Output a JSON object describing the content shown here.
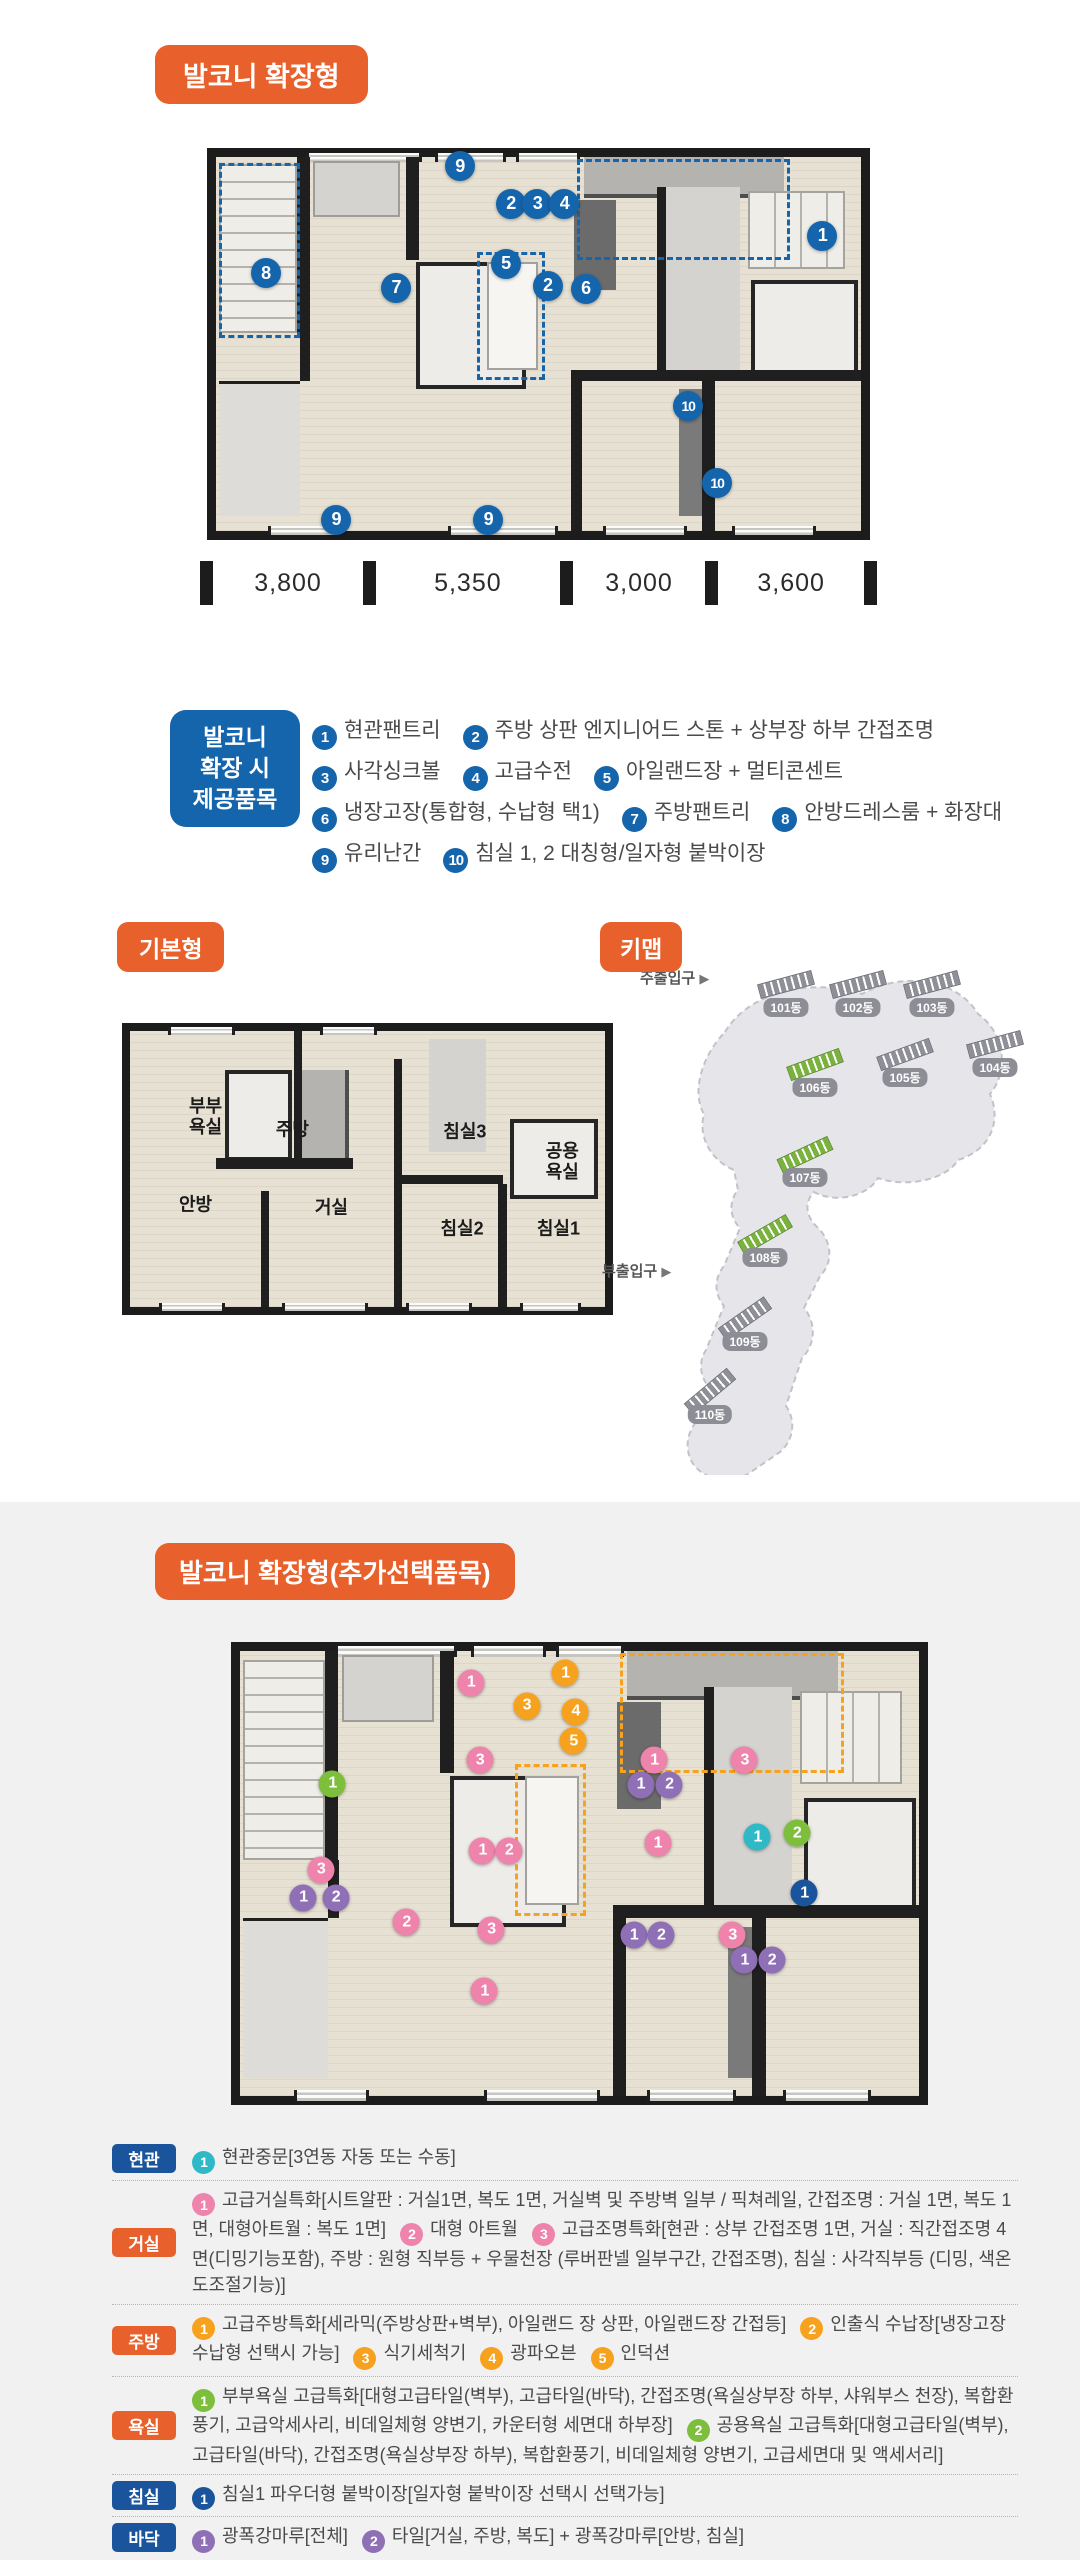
{
  "colors": {
    "accent_orange": "#e8612c",
    "accent_navy": "#1565ad",
    "marker_pink": "#ee84ab",
    "marker_orange": "#f6a21e",
    "marker_purple": "#8f6fb5",
    "marker_green": "#7dbf3c",
    "marker_teal": "#2fb9c7",
    "floor_beige": "#e7e1d3",
    "wall_dark": "#1c1c1c",
    "section_gray": "#f1f1f1"
  },
  "section_extended": {
    "title": "발코니 확장형",
    "dimensions": [
      {
        "text": "3,800",
        "weight": 3800
      },
      {
        "text": "5,350",
        "weight": 5350
      },
      {
        "text": "3,000",
        "weight": 3000
      },
      {
        "text": "3,600",
        "weight": 3600
      }
    ],
    "provision_badge_lines": [
      "발코니",
      "확장 시",
      "제공품목"
    ],
    "provision_lines": [
      [
        {
          "num": "1",
          "text": "현관팬트리"
        },
        {
          "num": "2",
          "text": "주방 상판 엔지니어드 스톤 + 상부장 하부 간접조명"
        }
      ],
      [
        {
          "num": "3",
          "text": "사각싱크볼"
        },
        {
          "num": "4",
          "text": "고급수전"
        },
        {
          "num": "5",
          "text": "아일랜드장 + 멀티콘센트"
        }
      ],
      [
        {
          "num": "6",
          "text": "냉장고장(통합형, 수납형 택1)"
        },
        {
          "num": "7",
          "text": "주방팬트리"
        },
        {
          "num": "8",
          "text": "안방드레스룸 + 화장대"
        }
      ],
      [
        {
          "num": "9",
          "text": "유리난간"
        },
        {
          "num": "10",
          "text": "침실 1, 2 대칭형/일자형 붙박이장"
        }
      ]
    ],
    "plan_markers": [
      {
        "num": "9",
        "x": 37.8,
        "y": 2.5
      },
      {
        "num": "2",
        "x": 45.7,
        "y": 12.5
      },
      {
        "num": "3",
        "x": 49.8,
        "y": 12.5
      },
      {
        "num": "4",
        "x": 54.0,
        "y": 12.5
      },
      {
        "num": "1",
        "x": 94.0,
        "y": 21.0
      },
      {
        "num": "5",
        "x": 44.9,
        "y": 28.6
      },
      {
        "num": "2",
        "x": 51.4,
        "y": 34.4
      },
      {
        "num": "6",
        "x": 57.3,
        "y": 35.2
      },
      {
        "num": "7",
        "x": 27.9,
        "y": 35.0
      },
      {
        "num": "8",
        "x": 7.7,
        "y": 31.1
      },
      {
        "num": "10",
        "x": 73.2,
        "y": 66.6
      },
      {
        "num": "10",
        "x": 77.7,
        "y": 87.2
      },
      {
        "num": "9",
        "x": 18.6,
        "y": 97.0
      },
      {
        "num": "9",
        "x": 42.2,
        "y": 97.0
      }
    ]
  },
  "section_basic": {
    "title": "기본형",
    "rooms": [
      {
        "label": "부부\n욕실",
        "x": 15.9,
        "y": 31.0
      },
      {
        "label": "주방",
        "x": 34.2,
        "y": 36.0
      },
      {
        "label": "안방",
        "x": 13.8,
        "y": 63.0
      },
      {
        "label": "거실",
        "x": 42.4,
        "y": 64.0
      },
      {
        "label": "침실3",
        "x": 70.5,
        "y": 36.6
      },
      {
        "label": "공용\n욕실",
        "x": 91.0,
        "y": 47.6
      },
      {
        "label": "침실2",
        "x": 69.9,
        "y": 71.6
      },
      {
        "label": "침실1",
        "x": 90.2,
        "y": 71.6
      }
    ]
  },
  "keymap": {
    "title": "키맵",
    "main_entrance": "주출입구",
    "sub_entrance": "부출입구",
    "buildings": [
      {
        "label": "101동",
        "x": 186,
        "y": 73,
        "rot": -15,
        "hl": false
      },
      {
        "label": "102동",
        "x": 258,
        "y": 73,
        "rot": -15,
        "hl": false
      },
      {
        "label": "103동",
        "x": 332,
        "y": 73,
        "rot": -15,
        "hl": false
      },
      {
        "label": "104동",
        "x": 395,
        "y": 133,
        "rot": -15,
        "hl": false
      },
      {
        "label": "105동",
        "x": 305,
        "y": 143,
        "rot": -20,
        "hl": false
      },
      {
        "label": "106동",
        "x": 215,
        "y": 153,
        "rot": -20,
        "hl": true
      },
      {
        "label": "107동",
        "x": 205,
        "y": 243,
        "rot": -25,
        "hl": true
      },
      {
        "label": "108동",
        "x": 165,
        "y": 323,
        "rot": -30,
        "hl": true
      },
      {
        "label": "109동",
        "x": 145,
        "y": 407,
        "rot": -35,
        "hl": false
      },
      {
        "label": "110동",
        "x": 110,
        "y": 480,
        "rot": -40,
        "hl": false
      }
    ]
  },
  "section_options": {
    "title": "발코니 확장형(추가선택품목)",
    "plan_markers": [
      {
        "num": "1",
        "color": "orange",
        "x": 47.9,
        "y": 5.0
      },
      {
        "num": "1",
        "color": "pink",
        "x": 34.0,
        "y": 7.1
      },
      {
        "num": "3",
        "color": "orange",
        "x": 42.2,
        "y": 12.3
      },
      {
        "num": "4",
        "color": "orange",
        "x": 49.4,
        "y": 13.6
      },
      {
        "num": "5",
        "color": "orange",
        "x": 49.1,
        "y": 20.3
      },
      {
        "num": "3",
        "color": "pink",
        "x": 35.3,
        "y": 24.6
      },
      {
        "num": "1",
        "color": "green",
        "x": 13.6,
        "y": 29.8
      },
      {
        "num": "3",
        "color": "pink",
        "x": 11.9,
        "y": 49.2
      },
      {
        "num": "1",
        "color": "purple",
        "x": 9.3,
        "y": 55.5
      },
      {
        "num": "2",
        "color": "purple",
        "x": 14.1,
        "y": 55.5
      },
      {
        "num": "1",
        "color": "pink",
        "x": 35.7,
        "y": 44.9
      },
      {
        "num": "2",
        "color": "pink",
        "x": 39.6,
        "y": 44.9
      },
      {
        "num": "2",
        "color": "pink",
        "x": 24.5,
        "y": 60.9
      },
      {
        "num": "3",
        "color": "pink",
        "x": 37.0,
        "y": 62.6
      },
      {
        "num": "1",
        "color": "pink",
        "x": 36.0,
        "y": 76.5
      },
      {
        "num": "1",
        "color": "pink",
        "x": 61.0,
        "y": 24.6
      },
      {
        "num": "1",
        "color": "purple",
        "x": 59.0,
        "y": 30.0
      },
      {
        "num": "2",
        "color": "purple",
        "x": 63.2,
        "y": 30.0
      },
      {
        "num": "3",
        "color": "pink",
        "x": 74.3,
        "y": 24.6
      },
      {
        "num": "1",
        "color": "pink",
        "x": 61.5,
        "y": 43.2
      },
      {
        "num": "1",
        "color": "teal",
        "x": 76.2,
        "y": 41.9
      },
      {
        "num": "2",
        "color": "green",
        "x": 82.0,
        "y": 41.0
      },
      {
        "num": "1",
        "color": "navy",
        "x": 83.1,
        "y": 54.4
      },
      {
        "num": "1",
        "color": "purple",
        "x": 58.0,
        "y": 63.9
      },
      {
        "num": "2",
        "color": "purple",
        "x": 62.0,
        "y": 63.9
      },
      {
        "num": "3",
        "color": "pink",
        "x": 72.5,
        "y": 63.9
      },
      {
        "num": "1",
        "color": "purple",
        "x": 74.3,
        "y": 69.5
      },
      {
        "num": "2",
        "color": "purple",
        "x": 78.3,
        "y": 69.5
      }
    ],
    "legend": [
      {
        "category": "현관",
        "badge_color": "navy",
        "items": [
          {
            "num": "1",
            "color": "teal",
            "text": "현관중문[3연동 자동 또는 수동]"
          }
        ]
      },
      {
        "category": "거실",
        "badge_color": "orange",
        "items": [
          {
            "num": "1",
            "color": "pink",
            "text": "고급거실특화[시트알판 : 거실1면, 복도 1면, 거실벽 및 주방벽 일부 / 픽쳐레일, 간접조명 : 거실 1면, 복도 1면, 대형아트월 : 복도 1면]"
          },
          {
            "num": "2",
            "color": "pink",
            "text": "대형 아트월"
          },
          {
            "num": "3",
            "color": "pink",
            "text": "고급조명특화[현관 : 상부 간접조명 1면, 거실 : 직간접조명 4면(디밍기능포함), 주방 : 원형 직부등 + 우물천장 (루버판넬 일부구간, 간접조명), 침실 : 사각직부등 (디밍, 색온도조절기능)]"
          }
        ]
      },
      {
        "category": "주방",
        "badge_color": "orange",
        "items": [
          {
            "num": "1",
            "color": "orange",
            "text": "고급주방특화[세라믹(주방상판+벽부), 아일랜드 장 상판, 아일랜드장 간접등]"
          },
          {
            "num": "2",
            "color": "orange",
            "text": "인출식 수납장[냉장고장 수납형 선택시 가능]"
          },
          {
            "num": "3",
            "color": "orange",
            "text": "식기세척기"
          },
          {
            "num": "4",
            "color": "orange",
            "text": "광파오븐"
          },
          {
            "num": "5",
            "color": "orange",
            "text": "인덕션"
          }
        ]
      },
      {
        "category": "욕실",
        "badge_color": "orange",
        "items": [
          {
            "num": "1",
            "color": "green",
            "text": "부부욕실 고급특화[대형고급타일(벽부), 고급타일(바닥), 간접조명(욕실상부장 하부, 샤워부스 천장), 복합환풍기, 고급악세사리, 비데일체형 양변기, 카운터형 세면대 하부장]"
          },
          {
            "num": "2",
            "color": "green",
            "text": "공용욕실 고급특화[대형고급타일(벽부), 고급타일(바닥), 간접조명(욕실상부장 하부), 복합환풍기, 비데일체형 양변기, 고급세면대 및 액세서리]"
          }
        ]
      },
      {
        "category": "침실",
        "badge_color": "navy",
        "items": [
          {
            "num": "1",
            "color": "navy",
            "text": "침실1 파우더형 붙박이장[일자형 붙박이장 선택시 선택가능]"
          }
        ]
      },
      {
        "category": "바닥",
        "badge_color": "navy",
        "items": [
          {
            "num": "1",
            "color": "purple",
            "text": "광폭강마루[전체]"
          },
          {
            "num": "2",
            "color": "purple",
            "text": "타일[거실, 주방, 복도] + 광폭강마루[안방, 침실]"
          }
        ]
      }
    ]
  }
}
